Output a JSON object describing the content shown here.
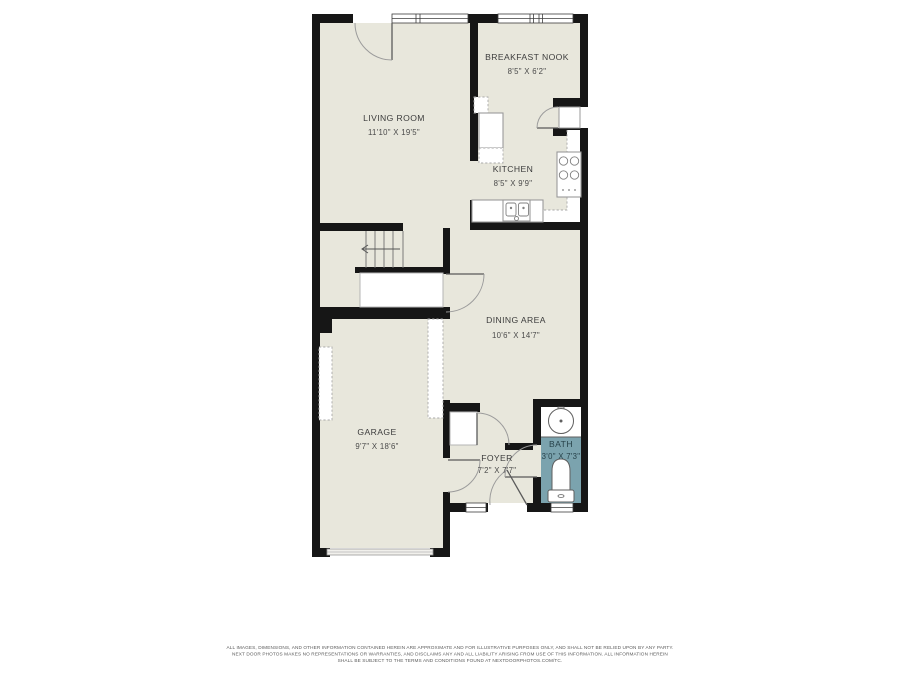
{
  "plan": {
    "colors": {
      "floor": "#e8e7dc",
      "bath_floor": "#7ba3ae",
      "wall": "#161616",
      "label": "#3c3c3c"
    },
    "rooms": {
      "living_room": {
        "name": "LIVING ROOM",
        "dims": "11'10\" X 19'5\""
      },
      "breakfast_nook": {
        "name": "BREAKFAST NOOK",
        "dims": "8'5\" X 6'2\""
      },
      "kitchen": {
        "name": "KITCHEN",
        "dims": "8'5\" X 9'9\""
      },
      "dining_area": {
        "name": "DINING AREA",
        "dims": "10'6\" X 14'7\""
      },
      "garage": {
        "name": "GARAGE",
        "dims": "9'7\" X 18'6\""
      },
      "foyer": {
        "name": "FOYER",
        "dims": "7'2\" X 7'7\""
      },
      "bath": {
        "name": "BATH",
        "dims": "3'0\" X 7'3\""
      }
    }
  },
  "disclaimer": {
    "line1": "ALL IMAGES, DIMENSIONS, AND OTHER INFORMATION CONTAINED HEREIN ARE APPROXIMATE AND FOR ILLUSTRATIVE PURPOSES ONLY, AND SHALL NOT BE RELIED UPON BY ANY PARTY.",
    "line2": "NEXT DOOR PHOTOS MAKES NO REPRESENTATIONS OR WARRANTIES, AND DISCLAIMS ANY AND ALL LIABILITY ARISING FROM USE OF THIS INFORMATION. ALL INFORMATION HEREIN",
    "line3": "SHALL BE SUBJECT TO THE TERMS AND CONDITIONS FOUND AT NEXTDOORPHOTOS.COM/TC."
  }
}
